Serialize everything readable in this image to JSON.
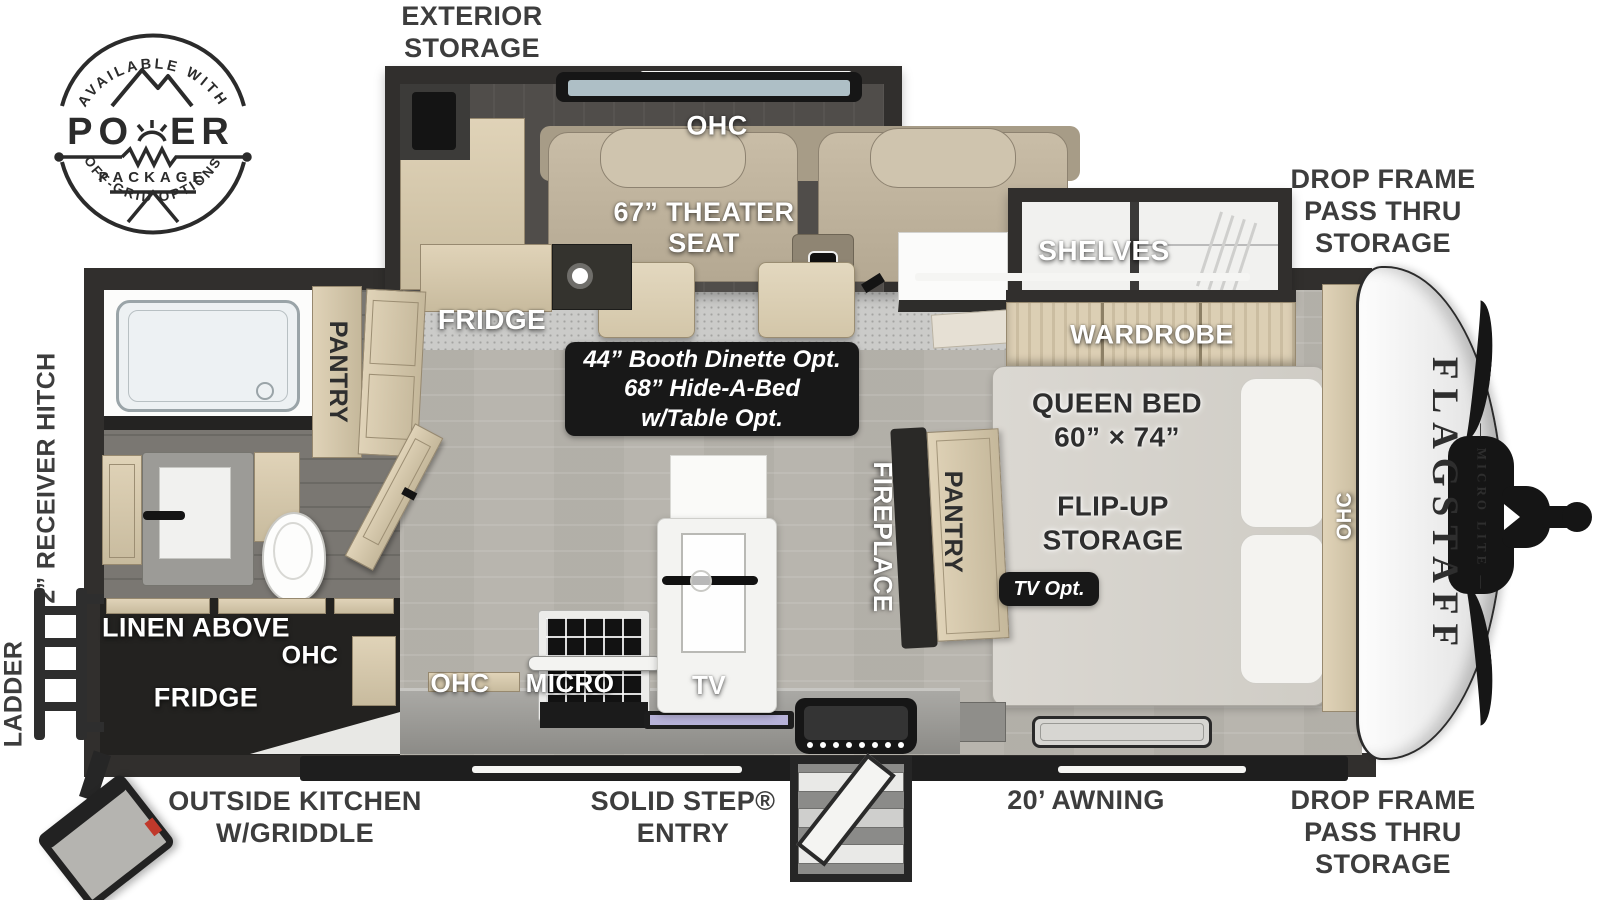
{
  "colors": {
    "wall": "#312f2d",
    "floor": "#b8b5ae",
    "wood": "#d6c9ae",
    "dark_panel": "#181818",
    "label_dark": "#3d3d3d",
    "label_light": "#ffffff",
    "tv_screen": "#b7b2d8",
    "accent_red": "#c0392b"
  },
  "logo": {
    "arc_top": "AVAILABLE WITH",
    "title_left": "PO",
    "title_right": "ER",
    "subtitle": "PACKAGE",
    "arc_bottom": "OFF-GRID OPTIONS"
  },
  "exterior": {
    "storage_top": "EXTERIOR\nSTORAGE",
    "drop_frame_top": "DROP FRAME\nPASS THRU\nSTORAGE",
    "drop_frame_bottom": "DROP FRAME\nPASS THRU\nSTORAGE",
    "outside_kitchen": "OUTSIDE KITCHEN\nW/GRIDDLE",
    "solid_step": "SOLID STEP®\nENTRY",
    "awning": "20’ AWNING",
    "receiver_hitch": "2” RECEIVER HITCH",
    "ladder": "LADDER"
  },
  "interior": {
    "ohc_slide": "OHC",
    "theater_seat": "67” THEATER\nSEAT",
    "shelves": "SHELVES",
    "wardrobe": "WARDROBE",
    "queen_bed": "QUEEN BED\n60” × 74”",
    "flip_up": "FLIP-UP\nSTORAGE",
    "tv_opt": "TV Opt.",
    "ohc_bed": "OHC",
    "fireplace": "FIREPLACE",
    "pantry_bed": "PANTRY",
    "pantry_bath": "PANTRY",
    "fridge": "FRIDGE",
    "dinette": "44” Booth Dinette Opt.\n68” Hide-A-Bed\nw/Table Opt.",
    "linen": "LINEN ABOVE",
    "ohc_rear": "OHC",
    "fridge_rear": "FRIDGE",
    "ohc_kitchen": "OHC",
    "micro": "MICRO",
    "tv": "TV"
  },
  "brand": {
    "name": "FLAGSTAFF",
    "sub": "— MICRO LITE —"
  }
}
